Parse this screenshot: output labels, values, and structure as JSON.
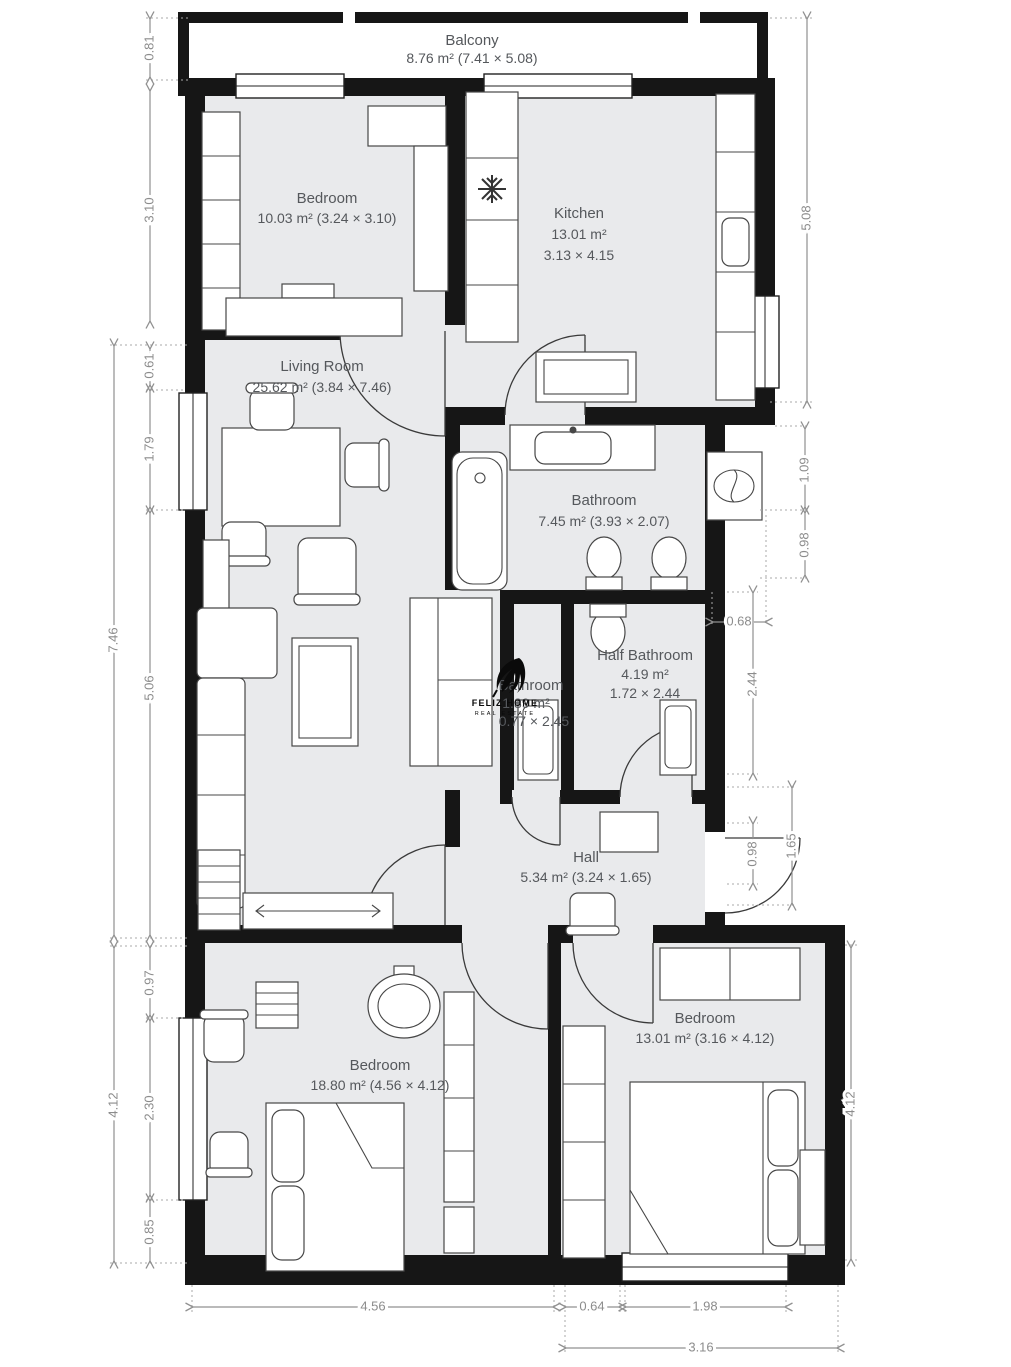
{
  "rooms": {
    "balcony": {
      "name": "Balcony",
      "area": "8.76 m² (7.41 × 5.08)"
    },
    "bedroom_top": {
      "name": "Bedroom",
      "area": "10.03 m² (3.24 × 3.10)"
    },
    "kitchen": {
      "name": "Kitchen",
      "area_line1": "13.01 m²",
      "area_line2": "3.13 × 4.15"
    },
    "living_room": {
      "name": "Living Room",
      "area": "25.62 m² (3.84 × 7.46)"
    },
    "bathroom": {
      "name": "Bathroom",
      "area": "7.45 m² (3.93 × 2.07)"
    },
    "small_bathroom": {
      "name": "Bathroom",
      "area_line1": "1.89 m²",
      "area_line2": "0.77 × 2.45"
    },
    "half_bathroom": {
      "name": "Half Bathroom",
      "area_line1": "4.19 m²",
      "area_line2": "1.72 × 2.44"
    },
    "hall": {
      "name": "Hall",
      "area": "5.34 m² (3.24 × 1.65)"
    },
    "bedroom_bottom_left": {
      "name": "Bedroom",
      "area": "18.80 m² (4.56 × 4.12)"
    },
    "bedroom_bottom_right": {
      "name": "Bedroom",
      "area": "13.01 m² (3.16 × 4.12)"
    }
  },
  "dimensions": {
    "left_outer": [
      "7.46",
      "4.12"
    ],
    "left_inner": [
      "0.81",
      "3.10",
      "0.61",
      "1.79",
      "5.06",
      "0.97",
      "2.30",
      "0.85"
    ],
    "right": [
      "5.08",
      "1.09",
      "0.98",
      "0.68",
      "2.44",
      "0.98",
      "1.65",
      "4.12"
    ],
    "bottom": [
      "4.56",
      "0.64",
      "1.98",
      "3.16"
    ]
  },
  "watermark": {
    "brand": "FELIZ HOME",
    "tagline": "REAL ESTATE"
  },
  "colors": {
    "floor": "#e9eaec",
    "wall": "#161616",
    "dimension": "#8f8f8f",
    "label": "#55585c"
  }
}
